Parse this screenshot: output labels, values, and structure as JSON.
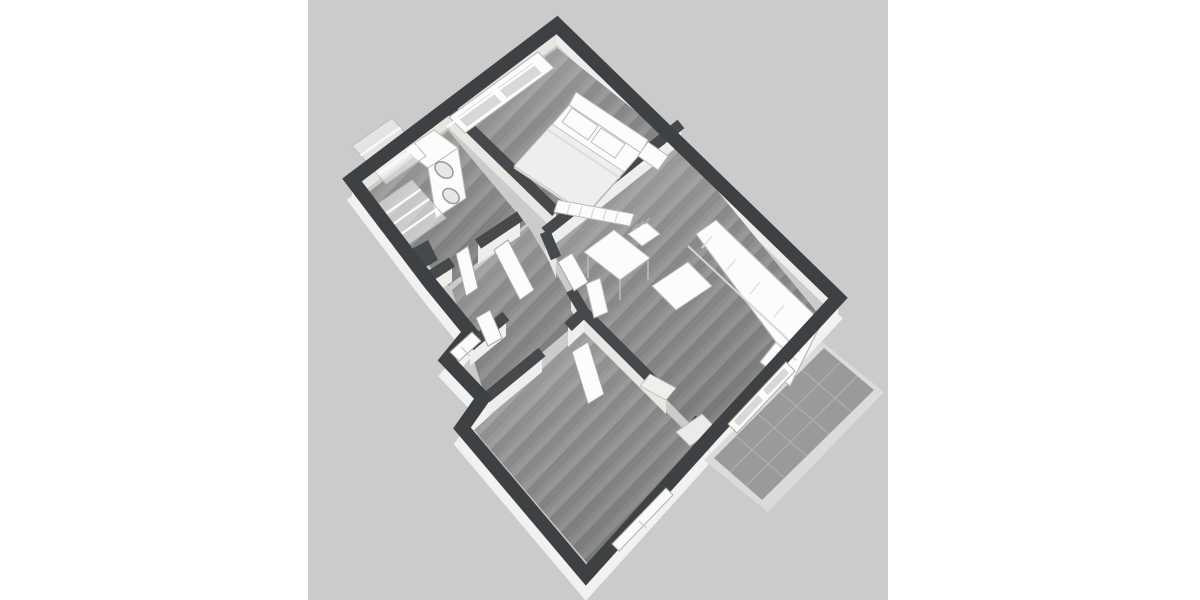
{
  "canvas": {
    "background": "#ffffff",
    "viewport_color": "#cbcbcb",
    "viewport_x": 308,
    "viewport_width": 580,
    "viewport_height": 600
  },
  "palette": {
    "wall_top_outer": "#3e4144",
    "wall_top_inner": "#46494c",
    "wall_face_nw": "#e8e6e2",
    "wall_face_ne": "#efedeb",
    "wall_face_outer": "#f3f2f0",
    "wall_face_inner_u": "#efeeec",
    "wall_face_inner_v": "#e9e7e4",
    "slab": "#f2f1ef",
    "floor_base": "#8e8d8b",
    "floor_stripe_dark": "#858482",
    "floor_stripe_light": "#969593",
    "patio_tile": "#9b9a98",
    "patio_grout": "#aeadab",
    "patio_border": "#dcdbd9",
    "furniture_white": "#fcfcfb",
    "furniture_shade": "#efeeec",
    "furniture_outline": "#bbbab8",
    "glass": "#d9d8d6"
  },
  "scene": {
    "type": "isometric-3d-floorplan-render",
    "rooms": [
      {
        "name": "bedroom"
      },
      {
        "name": "laundry-room"
      },
      {
        "name": "hallway"
      },
      {
        "name": "bathroom"
      },
      {
        "name": "living-room"
      },
      {
        "name": "second-bedroom"
      },
      {
        "name": "patio"
      }
    ],
    "furniture": [
      {
        "name": "double-bed"
      },
      {
        "name": "bed-pillows",
        "count": 2
      },
      {
        "name": "nightstand"
      },
      {
        "name": "bedroom-radiator"
      },
      {
        "name": "stacked-washer-dryer"
      },
      {
        "name": "drying-racks",
        "count": 2
      },
      {
        "name": "desk"
      },
      {
        "name": "desk-chair"
      },
      {
        "name": "coffee-table"
      },
      {
        "name": "corner-sofa"
      },
      {
        "name": "living-room-radiator"
      },
      {
        "name": "doorway-mats",
        "count": 2
      }
    ],
    "openings": [
      {
        "name": "bedroom-window"
      },
      {
        "name": "bathroom-window"
      },
      {
        "name": "second-bedroom-window"
      },
      {
        "name": "patio-sliding-door"
      },
      {
        "name": "interior-door-leaves",
        "count": 5
      }
    ]
  }
}
